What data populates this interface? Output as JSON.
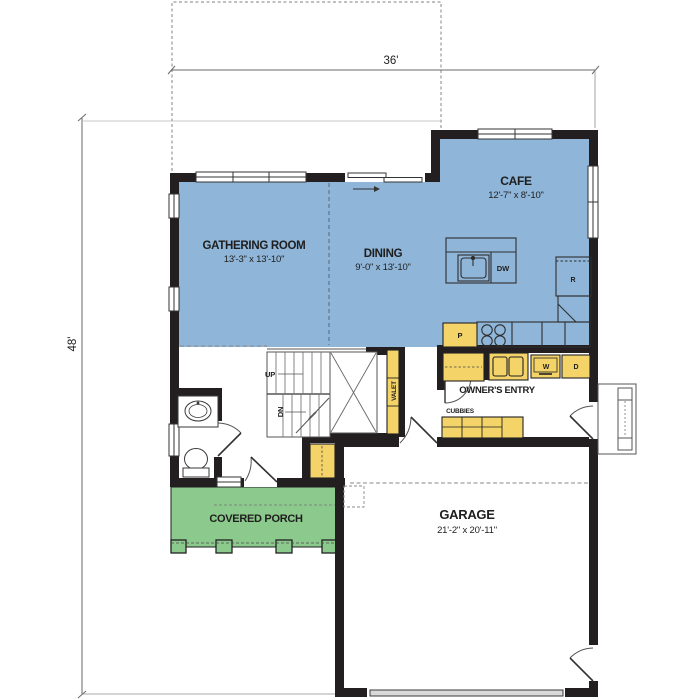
{
  "plan_dimensions": {
    "width_label": "36'",
    "depth_label": "48'"
  },
  "rooms": {
    "gathering": {
      "name": "GATHERING ROOM",
      "size": "13'-3\" x 13'-10\""
    },
    "dining": {
      "name": "DINING",
      "size": "9'-0\" x 13'-10\""
    },
    "cafe": {
      "name": "CAFE",
      "size": "12'-7\" x 8'-10\""
    },
    "garage": {
      "name": "GARAGE",
      "size": "21'-2\" x 20'-11\""
    },
    "porch": {
      "name": "COVERED PORCH"
    },
    "owners_entry": {
      "name": "OWNER'S ENTRY"
    }
  },
  "fixtures": {
    "stairs_up": "UP",
    "stairs_down": "DN",
    "valet": "VALET",
    "cubbies": "CUBBIES",
    "pantry": "P",
    "refrigerator": "R",
    "dishwasher": "DW",
    "washer": "W",
    "dryer": "D"
  },
  "colors": {
    "floor": "#8fb5d8",
    "porch": "#8cc98c",
    "cabinet": "#f4d469",
    "wall": "#231f20"
  }
}
